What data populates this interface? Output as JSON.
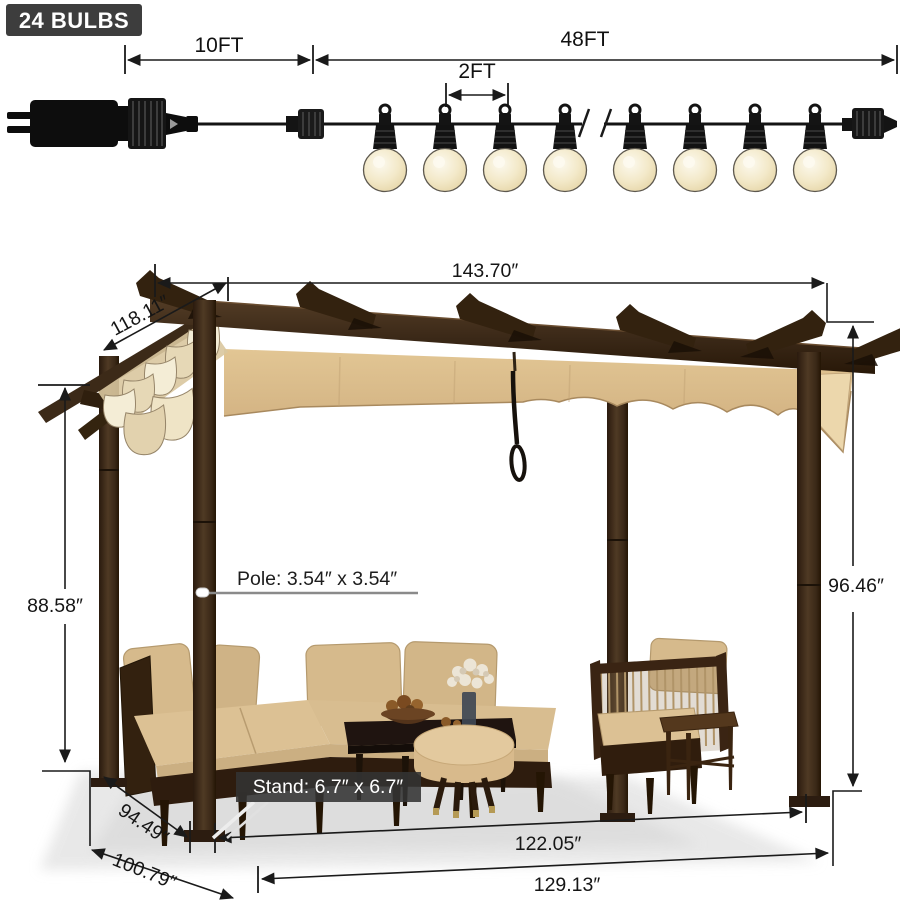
{
  "string_lights": {
    "badge_label": "24 BULBS",
    "lead_length_label": "10FT",
    "string_length_label": "48FT",
    "bulb_spacing_label": "2FT"
  },
  "pergola_dimensions": {
    "top_width": "143.70″",
    "top_depth": "118.11″",
    "post_height": "88.58″",
    "overall_height": "96.46″",
    "inner_depth": "94.49″",
    "base_depth": "100.79″",
    "inner_width": "122.05″",
    "base_width": "129.13″",
    "pole_size": "Pole: 3.54″ x 3.54″",
    "stand_size": "Stand: 6.7″ x 6.7″"
  },
  "colors": {
    "badge_bg": "#3d3d3d",
    "dimension_line": "#1a1a1a",
    "frame_brown": "#3a2817",
    "canopy_tan": "#d7b98c",
    "cushion_tan": "#d6ba8c",
    "bulb_glow": "#f1e6c2"
  }
}
